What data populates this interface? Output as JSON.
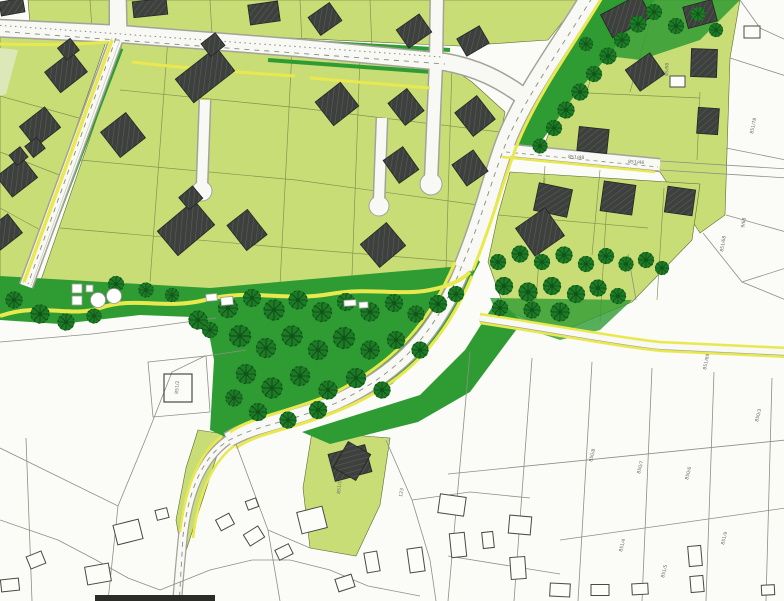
{
  "colors": {
    "bg": "#fbfbf8",
    "parcel": "#c9dd77",
    "parcelPale": "#dde8b8",
    "park": "#2f9c33",
    "tree": "#1e7a26",
    "treeDark": "#0f5418",
    "road": "#f8f8f4",
    "roadEdge": "#a3a399",
    "dash": "#8b8b82",
    "yellow": "#e9e94f",
    "building": "#3e403e",
    "buildingHatch": "#5a5c59",
    "outlineBuilding": "#fcfcf9",
    "cadLine": "#8f8f87",
    "innerLine": "#7d8c48",
    "label": "#6b6b62",
    "scanBar": "#2b2b28"
  },
  "map": {
    "labels": [
      {
        "text": "851/48"
      },
      {
        "text": "851/46"
      },
      {
        "text": "85/68"
      },
      {
        "text": "851/78"
      },
      {
        "text": "9/68"
      },
      {
        "text": "851/68"
      },
      {
        "text": "851/69"
      },
      {
        "text": "850/8"
      },
      {
        "text": "850/7"
      },
      {
        "text": "850/6"
      },
      {
        "text": "850/3"
      },
      {
        "text": "851/4"
      },
      {
        "text": "851/5"
      },
      {
        "text": "851/9"
      },
      {
        "text": "851/2"
      },
      {
        "text": "851/1"
      },
      {
        "text": "123"
      }
    ]
  }
}
